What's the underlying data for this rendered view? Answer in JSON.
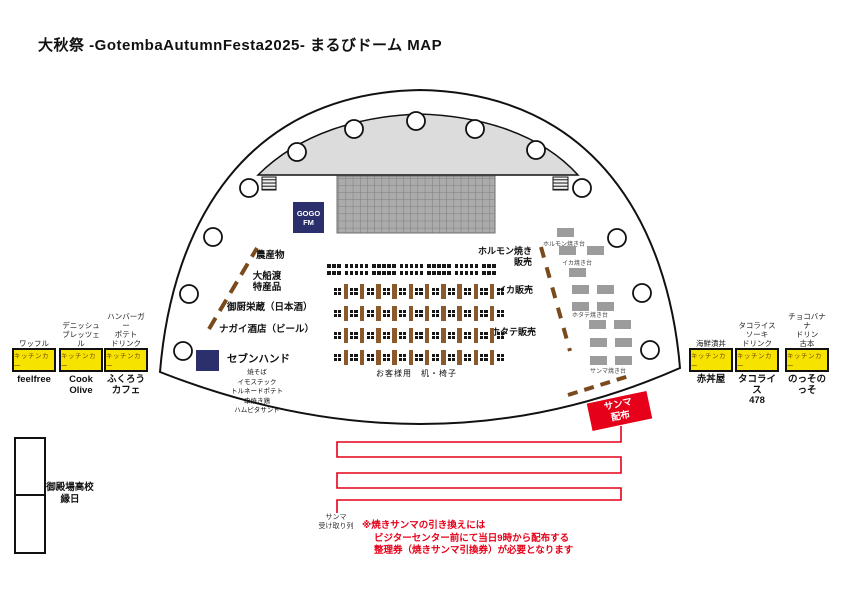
{
  "title": "大秋祭 -GotembaAutumnFesta2025- まるびドーム MAP",
  "stage": {
    "radio_booth": "GOGO\nFM"
  },
  "left_stalls": {
    "s1": "農産物",
    "s2": "大船渡\n特産品",
    "s3": "御厨栄蔵（日本酒）",
    "s4": "ナガイ酒店（ビール）",
    "seven_hand": "セブンハンド",
    "seven_hand_menu": "焼そば\nイモステック\nトルネードポテト\n串焼き鶏\nハムピタサンド"
  },
  "sales": {
    "s1": "ホルモン焼き\n販売",
    "s2": "イカ販売",
    "s3": "ホタテ販売"
  },
  "grills": {
    "l1": "ホルモン焼き台",
    "l2": "イカ焼き台",
    "l3": "ホタテ焼き台",
    "l4": "サンマ焼き台"
  },
  "seating": {
    "label": "お客様用　机・椅子",
    "top_row_groups": [
      3,
      5,
      5,
      5,
      5,
      5,
      3
    ],
    "top_rows": 2,
    "table_rows": 4,
    "tables_per_row": 10
  },
  "trucks_left": [
    {
      "menu": "ワッフル",
      "box": "キッチンカー",
      "name": "feelfree"
    },
    {
      "menu": "デニッシュ\nブレッツェル",
      "box": "キッチンカー",
      "name": "Cook\nOlive"
    },
    {
      "menu": "ハンバーガー\nポテト\nドリンク",
      "box": "キッチンカー",
      "name": "ふくろう\nカフェ"
    }
  ],
  "trucks_right": [
    {
      "menu": "海鮮漬丼",
      "box": "キッチンカー",
      "name": "赤丼屋"
    },
    {
      "menu": "タコライス\nソーキ\nドリンク",
      "box": "キッチンカー",
      "name": "タコライス\n478"
    },
    {
      "menu": "チョコバナナ\nドリン\n古本",
      "box": "キッチンカー",
      "name": "のっそのっそ"
    }
  ],
  "sanma": {
    "handout": "サンマ\n配布",
    "queue_label": "サンマ\n受け取り列",
    "notice": "※焼きサンマの引き換えには\nビジターセンター前にて当日9時から配布する\n整理券（焼きサンマ引換券）が必要となります"
  },
  "school": {
    "label": "御殿場高校\n縁日"
  },
  "colors": {
    "accent_red": "#e60019",
    "truck_yellow": "#f6e400",
    "booth_navy": "#2b2f6b",
    "table_brown": "#8a5a2a",
    "stand_gray": "#9c9c9c",
    "stage_gray": "#dcdcdc"
  }
}
